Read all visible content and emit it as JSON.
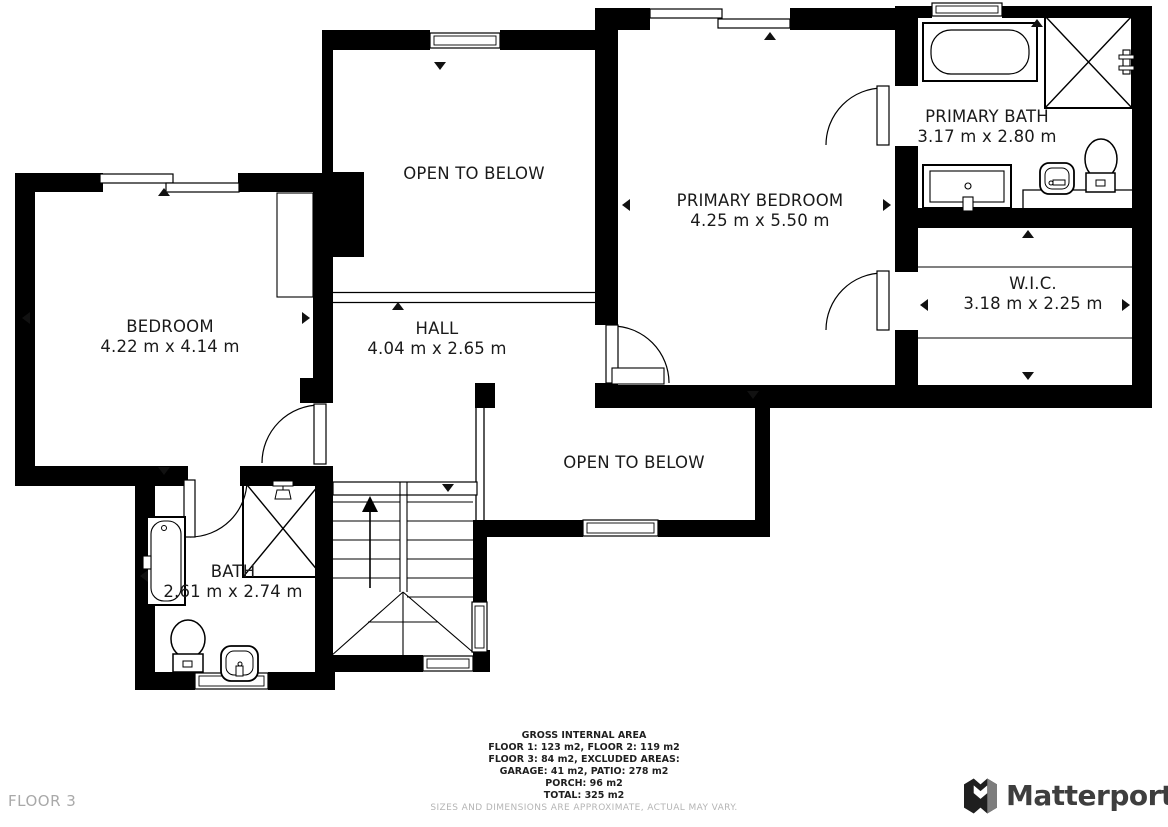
{
  "floor_label": "FLOOR 3",
  "rooms": [
    {
      "id": "open-to-below-top",
      "name": "OPEN TO BELOW",
      "dims": ""
    },
    {
      "id": "primary-bedroom",
      "name": "PRIMARY BEDROOM",
      "dims": "4.25 m x 5.50 m"
    },
    {
      "id": "primary-bath",
      "name": "PRIMARY BATH",
      "dims": "3.17 m x 2.80 m"
    },
    {
      "id": "wic",
      "name": "W.I.C.",
      "dims": "3.18 m x 2.25 m"
    },
    {
      "id": "bedroom",
      "name": "BEDROOM",
      "dims": "4.22 m x 4.14 m"
    },
    {
      "id": "hall",
      "name": "HALL",
      "dims": "4.04 m x 2.65 m"
    },
    {
      "id": "open-to-below-lower",
      "name": "OPEN TO BELOW",
      "dims": ""
    },
    {
      "id": "bath",
      "name": "BATH",
      "dims": "2.61 m x 2.74 m"
    }
  ],
  "footer": {
    "title": "GROSS INTERNAL AREA",
    "lines": [
      "FLOOR 1: 123 m2, FLOOR 2: 119 m2",
      "FLOOR 3: 84 m2, EXCLUDED AREAS:",
      "GARAGE: 41 m2, PATIO: 278 m2",
      "PORCH: 96 m2",
      "TOTAL: 325 m2"
    ],
    "disclaimer": "SIZES AND DIMENSIONS ARE APPROXIMATE, ACTUAL MAY VARY."
  },
  "logo": {
    "text": "Matterport"
  },
  "colors": {
    "wall": "#000000",
    "text": "#1a1a1a",
    "muted_text": "#b5b5b5",
    "floor_label": "#a9a9a9",
    "logo_text": "#3e3e3e"
  }
}
